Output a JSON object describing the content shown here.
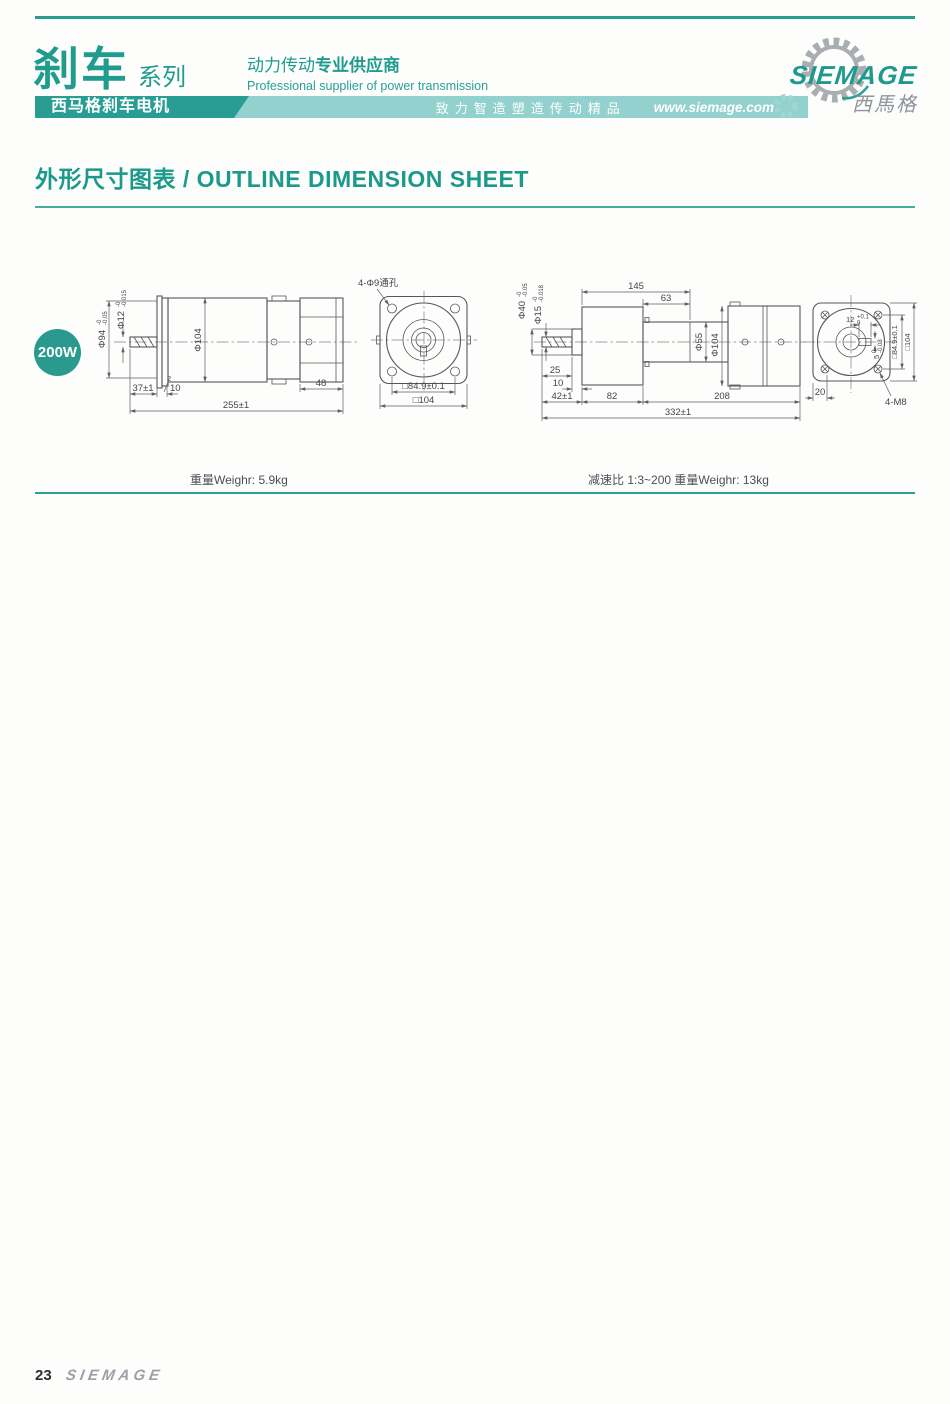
{
  "header": {
    "series": "刹车",
    "series_suffix": "系列",
    "bar_label": "西马格刹车电机",
    "tagline_normal": "动力传动",
    "tagline_bold": "专业供应商",
    "tagline_en": "Professional supplier of power transmission",
    "slogan": "致力智造塑造传动精品",
    "website": "www.siemage.com",
    "brand": "SIEMAGE",
    "brand_cn": "西馬格",
    "accent_color": "#2a9d92",
    "band_color": "#92d1cd"
  },
  "section": {
    "title": "外形尺寸图表 / OUTLINE DIMENSION SHEET"
  },
  "badge": {
    "label": "200W"
  },
  "drawing_left": {
    "dia94": {
      "v": "Φ94",
      "up": "-0",
      "dn": "-0.05"
    },
    "dia12": {
      "v": "Φ12",
      "up": "-0",
      "dn": "-0.015"
    },
    "dia104": "Φ104",
    "len2": "2",
    "len37": "37±1",
    "len10": "10",
    "len48": "48",
    "len255": "255±1",
    "holes": "4-Φ9通孔",
    "sq849": "□84.9±0.1",
    "sq104": "□104"
  },
  "drawing_right": {
    "len145": "145",
    "len63": "63",
    "dia40": {
      "v": "Φ40",
      "up": "-0",
      "dn": "-0.05"
    },
    "dia15": {
      "v": "Φ15",
      "up": "-0",
      "dn": "-0.018"
    },
    "dia55": "Φ55",
    "dia104": "Φ104",
    "len25": "25",
    "len10": "10",
    "len42": "42±1",
    "len82": "82",
    "len208": "208",
    "len332": "332±1",
    "key12": {
      "v": "12",
      "up": "+0.1",
      "dn": "0"
    },
    "key5": {
      "v": "5",
      "up": "0",
      "dn": "-0.03"
    },
    "sq849": "□84.9±0.1",
    "sq104": "□104",
    "len20": "20",
    "tap": "4-M8"
  },
  "captions": {
    "left": "重量Weighr: 5.9kg",
    "right": "减速比 1:3~200  重量Weighr: 13kg"
  },
  "footer": {
    "page": "23",
    "brand": "SIEMAGE"
  }
}
